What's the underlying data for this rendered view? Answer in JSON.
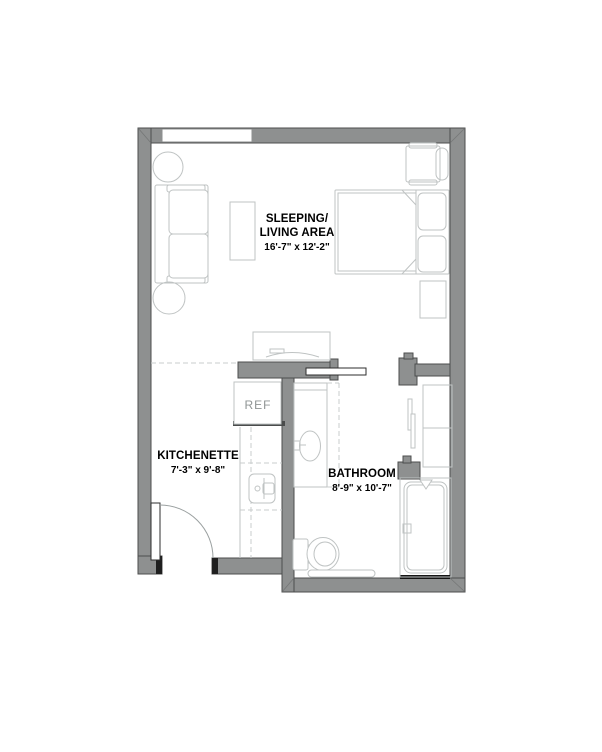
{
  "plan": {
    "type": "floor-plan",
    "unit": "studio apartment",
    "rooms": {
      "sleeping_living": {
        "label_line1": "SLEEPING/",
        "label_line2": "LIVING AREA",
        "dimensions": "16'-7\" x 12'-2\""
      },
      "kitchenette": {
        "label": "KITCHENETTE",
        "dimensions": "7'-3\" x 9'-8\""
      },
      "bathroom": {
        "label": "BATHROOM",
        "dimensions": "8'-9\" x 10'-7\""
      }
    },
    "appliances": {
      "refrigerator_label": "REF"
    },
    "fixtures": [
      "window",
      "entry-door",
      "pocket-door",
      "sofa",
      "side-table-round-upper",
      "side-table-round-lower",
      "coffee-table",
      "tv-console",
      "armchair",
      "bed",
      "pillows",
      "nightstand",
      "refrigerator",
      "kitchen-counter",
      "cooktop-sink",
      "bathroom-vanity",
      "vanity-sink",
      "toilet",
      "grab-bar",
      "shower",
      "shower-head",
      "floor-drain",
      "closet-shelving",
      "closet-sliding-door"
    ],
    "colors": {
      "wall_fill": "#8e9090",
      "wall_outline": "#4c4e4e",
      "furniture_line": "#bfc3c3",
      "text": "#000000",
      "ref_text": "#8f9494",
      "background": "#ffffff"
    }
  }
}
